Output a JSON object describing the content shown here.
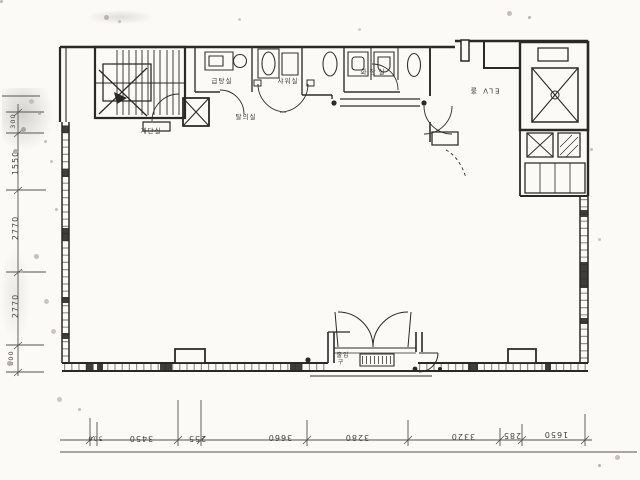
{
  "document_type": "scanned architectural floor plan",
  "labels": {
    "stair_room": "계단실",
    "boiler_room": "급탕실",
    "shower_room": "샤워실",
    "dressing_room": "탈의실",
    "toilet_room": "화장실",
    "elevator_hall": "ELV 홀",
    "entrance_line1": "출입",
    "entrance_line2": "구"
  },
  "dimensions": {
    "bottom": [
      "300",
      "3450",
      "255",
      "3660",
      "3280",
      "3320",
      "285",
      "1650"
    ],
    "left": [
      "300",
      "1550",
      "2770",
      "2770",
      "600"
    ]
  },
  "colors": {
    "ink": "#2b2926",
    "paper": "#fbfaf7",
    "dim_ink": "#45433d"
  }
}
